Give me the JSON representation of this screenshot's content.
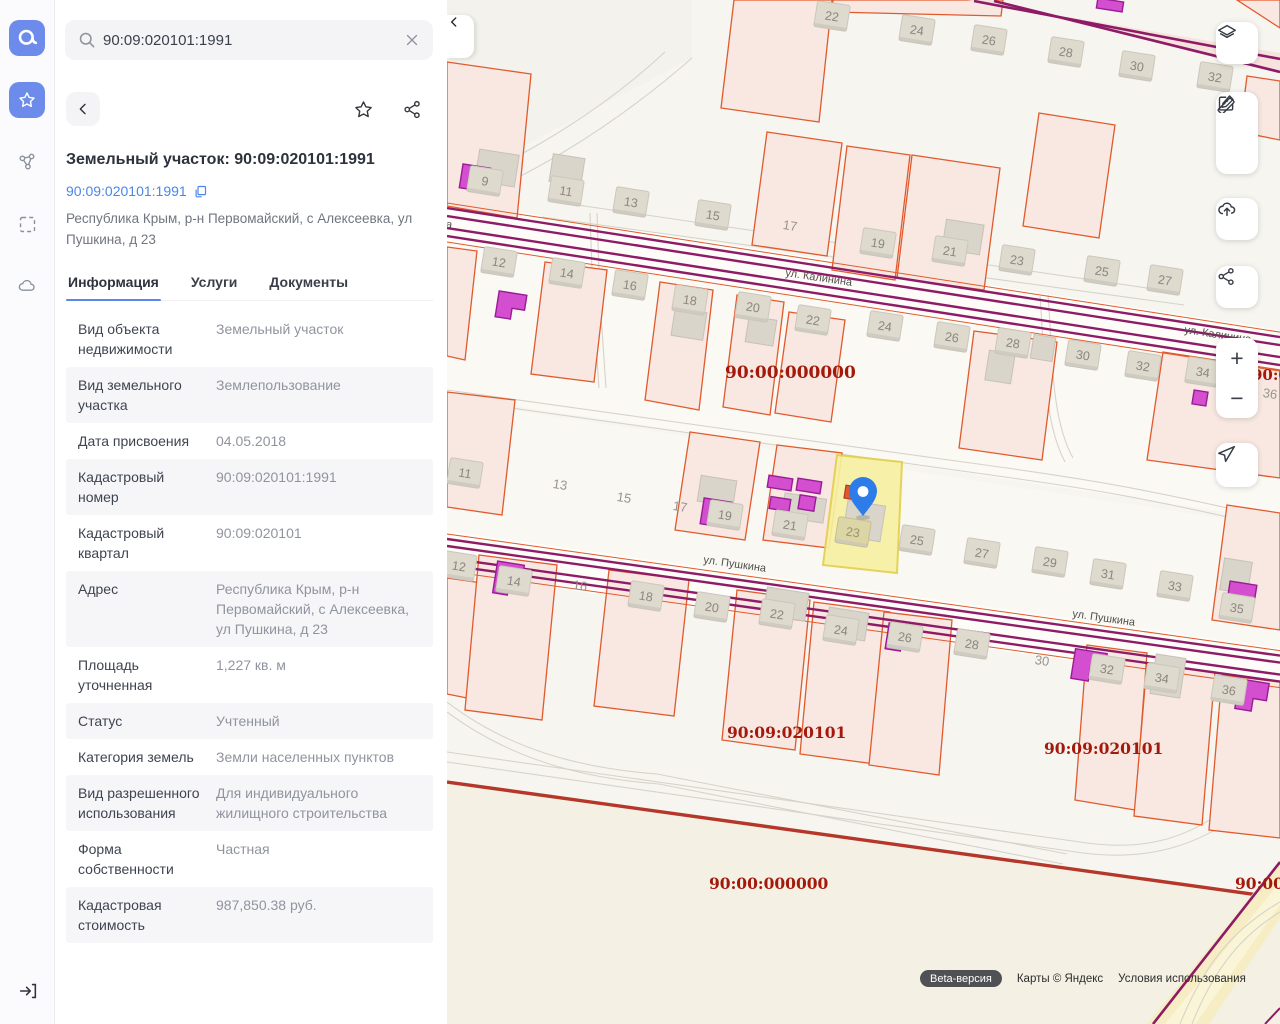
{
  "search": {
    "value": "90:09:020101:1991"
  },
  "rail": {
    "logo": "nspd-logo",
    "items": [
      {
        "name": "favorites",
        "icon": "star-icon",
        "active": true
      },
      {
        "name": "layers-graph",
        "icon": "polygon-nodes-icon",
        "active": false
      },
      {
        "name": "area-select",
        "icon": "dashed-square-icon",
        "active": false
      },
      {
        "name": "cloud",
        "icon": "cloud-icon",
        "active": false
      },
      {
        "name": "sign-in",
        "icon": "login-icon",
        "active": false
      }
    ]
  },
  "details": {
    "title": "Земельный участок: 90:09:020101:1991",
    "cadastral_link": "90:09:020101:1991",
    "address": "Республика Крым, р-н Первомайский, с Алексеевка, ул Пушкина, д 23",
    "tabs": [
      {
        "label": "Информация",
        "active": true
      },
      {
        "label": "Услуги",
        "active": false
      },
      {
        "label": "Документы",
        "active": false
      }
    ],
    "rows": [
      {
        "label": "Вид объекта недвижимости",
        "value": "Земельный участок"
      },
      {
        "label": "Вид земельного участка",
        "value": "Землепользование"
      },
      {
        "label": "Дата присвоения",
        "value": "04.05.2018"
      },
      {
        "label": "Кадастровый номер",
        "value": "90:09:020101:1991"
      },
      {
        "label": "Кадастровый квартал",
        "value": "90:09:020101"
      },
      {
        "label": "Адрес",
        "value": "Республика Крым, р-н Первомайский, с Алексеевка, ул Пушкина, д 23"
      },
      {
        "label": "Площадь уточненная",
        "value": "1,227 кв. м"
      },
      {
        "label": "Статус",
        "value": "Учтенный"
      },
      {
        "label": "Категория земель",
        "value": "Земли населенных пунктов"
      },
      {
        "label": "Вид разрешенного использования",
        "value": "Для индивидуального жилищного строительства"
      },
      {
        "label": "Форма собственности",
        "value": "Частная"
      },
      {
        "label": "Кадастровая стоимость",
        "value": "987,850.38 руб."
      }
    ]
  },
  "toolbar": {
    "buttons": [
      "layers",
      "ruler",
      "edit",
      "upload",
      "share",
      "zoom-in",
      "zoom-out",
      "locate"
    ]
  },
  "map": {
    "selected_parcel": {
      "number": "23",
      "cadastral": "90:09:020101:1991"
    },
    "street_labels": [
      {
        "t": "ул. Калинина",
        "x": -62,
        "y": 219,
        "r": 8
      },
      {
        "t": "ул. Калинина",
        "x": 338,
        "y": 276,
        "r": 8.5
      },
      {
        "t": "ул. Калинина",
        "x": 737,
        "y": 333,
        "r": 8.5
      },
      {
        "t": "ул. Пушкина",
        "x": 256,
        "y": 563,
        "r": 8
      },
      {
        "t": "ул. Пушкина",
        "x": 625,
        "y": 617,
        "r": 8
      }
    ],
    "quarter_labels": [
      {
        "t": "90:00:000000",
        "x": 278,
        "y": 378,
        "s": 17
      },
      {
        "t": "90:00:000000",
        "x": 805,
        "y": 380,
        "s": 15
      },
      {
        "t": "90:09:020101",
        "x": 280,
        "y": 738,
        "s": 15.5
      },
      {
        "t": "90:09:020101",
        "x": 597,
        "y": 754,
        "s": 15.5
      },
      {
        "t": "90:00:000000",
        "x": 262,
        "y": 889,
        "s": 15.5
      },
      {
        "t": "90:00:000000",
        "x": 788,
        "y": 889,
        "s": 15.5
      }
    ],
    "plates": [
      {
        "n": "22",
        "x": 385,
        "y": 16
      },
      {
        "n": "24",
        "x": 470,
        "y": 30
      },
      {
        "n": "26",
        "x": 542,
        "y": 40
      },
      {
        "n": "28",
        "x": 619,
        "y": 52
      },
      {
        "n": "30",
        "x": 690,
        "y": 66
      },
      {
        "n": "32",
        "x": 768,
        "y": 77
      },
      {
        "n": "9",
        "x": 38,
        "y": 181
      },
      {
        "n": "11",
        "x": 119,
        "y": 191
      },
      {
        "n": "13",
        "x": 184,
        "y": 202
      },
      {
        "n": "15",
        "x": 266,
        "y": 215
      },
      {
        "n": "17",
        "x": 343,
        "y": 226,
        "v": 1
      },
      {
        "n": "19",
        "x": 431,
        "y": 243
      },
      {
        "n": "21",
        "x": 503,
        "y": 251
      },
      {
        "n": "23",
        "x": 570,
        "y": 260
      },
      {
        "n": "25",
        "x": 655,
        "y": 271
      },
      {
        "n": "27",
        "x": 718,
        "y": 280
      },
      {
        "n": "12",
        "x": 52,
        "y": 262
      },
      {
        "n": "14",
        "x": 120,
        "y": 273
      },
      {
        "n": "16",
        "x": 183,
        "y": 285
      },
      {
        "n": "18",
        "x": 243,
        "y": 300
      },
      {
        "n": "20",
        "x": 306,
        "y": 307
      },
      {
        "n": "22",
        "x": 366,
        "y": 320
      },
      {
        "n": "24",
        "x": 438,
        "y": 326
      },
      {
        "n": "26",
        "x": 505,
        "y": 337
      },
      {
        "n": "28",
        "x": 566,
        "y": 343
      },
      {
        "n": "30",
        "x": 636,
        "y": 355
      },
      {
        "n": "32",
        "x": 696,
        "y": 366
      },
      {
        "n": "34",
        "x": 756,
        "y": 372
      },
      {
        "n": "36",
        "x": 823,
        "y": 394,
        "v": 1
      },
      {
        "n": "11",
        "x": 18,
        "y": 473
      },
      {
        "n": "13",
        "x": 113,
        "y": 485,
        "v": 1
      },
      {
        "n": "15",
        "x": 177,
        "y": 498,
        "v": 1
      },
      {
        "n": "17",
        "x": 233,
        "y": 507,
        "v": 1
      },
      {
        "n": "19",
        "x": 278,
        "y": 515
      },
      {
        "n": "21",
        "x": 343,
        "y": 525
      },
      {
        "n": "23",
        "x": 406,
        "y": 532,
        "v": 2
      },
      {
        "n": "25",
        "x": 470,
        "y": 540
      },
      {
        "n": "27",
        "x": 535,
        "y": 553
      },
      {
        "n": "29",
        "x": 603,
        "y": 562
      },
      {
        "n": "31",
        "x": 661,
        "y": 574
      },
      {
        "n": "33",
        "x": 728,
        "y": 586
      },
      {
        "n": "35",
        "x": 790,
        "y": 608
      },
      {
        "n": "12",
        "x": 12,
        "y": 566
      },
      {
        "n": "14",
        "x": 67,
        "y": 581
      },
      {
        "n": "16",
        "x": 133,
        "y": 586,
        "v": 1
      },
      {
        "n": "18",
        "x": 199,
        "y": 596
      },
      {
        "n": "20",
        "x": 265,
        "y": 607
      },
      {
        "n": "22",
        "x": 330,
        "y": 614
      },
      {
        "n": "24",
        "x": 394,
        "y": 630
      },
      {
        "n": "26",
        "x": 458,
        "y": 637
      },
      {
        "n": "28",
        "x": 525,
        "y": 644
      },
      {
        "n": "30",
        "x": 595,
        "y": 661,
        "v": 1
      },
      {
        "n": "32",
        "x": 660,
        "y": 669
      },
      {
        "n": "34",
        "x": 715,
        "y": 678
      },
      {
        "n": "36",
        "x": 782,
        "y": 690
      }
    ],
    "attribution": {
      "beta": "Beta-версия",
      "copyright": "Карты © Яндекс",
      "terms": "Условия использования"
    },
    "colors": {
      "parcel_fill": "#f8e8e1",
      "parcel_stroke": "#e15a2d",
      "road_purple": "#8e1b66",
      "boundary_red": "#b5372a",
      "selected_fill": "#f7f0a2",
      "selected_stroke": "#e3d04a",
      "building_magenta": "#d44ed0",
      "pin_blue": "#2e7ce9",
      "label_red": "#a31a0c"
    }
  }
}
